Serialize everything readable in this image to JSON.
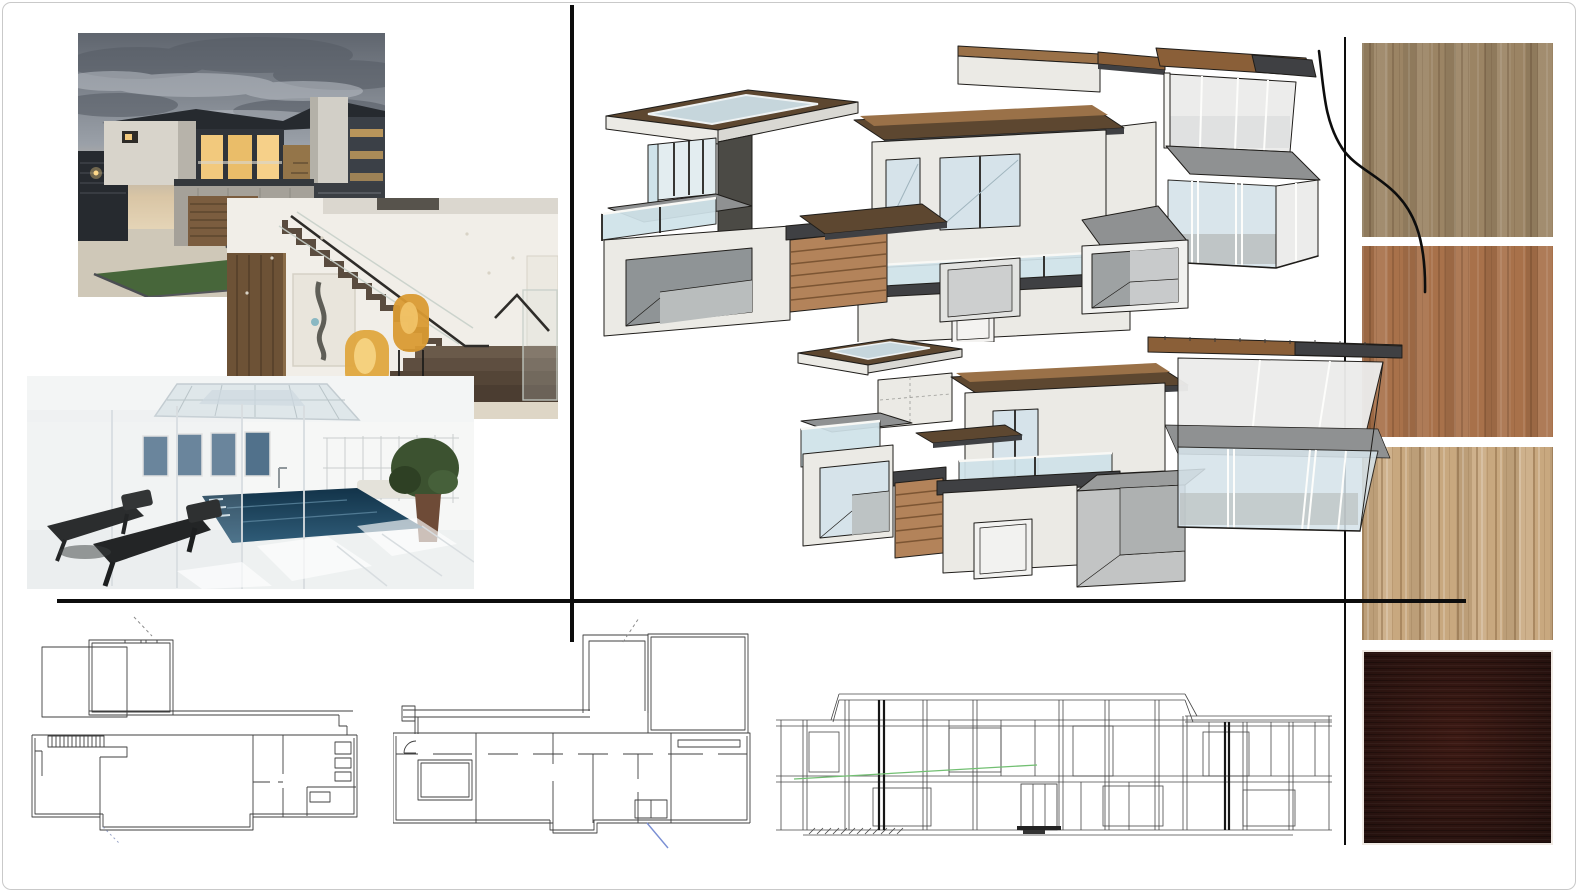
{
  "board": {
    "type": "architecture-design-moodboard",
    "background": "#ffffff",
    "frame_color": "#c9c9c9"
  },
  "palette": {
    "page_bg": "#ffffff",
    "page_border": "#c9c9c9",
    "divider": "#0d0d0d",
    "ink": "#1f1d1a",
    "wall": "#ebeae5",
    "wall_shade": "#d9d8d3",
    "wall_dark": "#4b4a45",
    "roof_brown": "#8a5f38",
    "roof_dark": "#5d4730",
    "roof_cap": "#9a7148",
    "fascia_dark": "#3f4043",
    "slab_gray": "#8f9192",
    "glass_blue": "#cfe2e9",
    "glass_pale": "#ececeb",
    "glass_sky": "#d6e3ea",
    "slat_wood": "#b3835a",
    "slat_line": "#7c5533",
    "concrete": "#a5a199",
    "plan_line": "#3f3f3f",
    "plan_soft": "#8a8a8a",
    "plan_blue": "#7a8fd4",
    "plan_green": "#72bf72",
    "sky_top": "#5f656e",
    "sky_mid": "#9aa0a8",
    "sky_glow": "#d9c5a5",
    "cloud_dark": "#575d66",
    "cloud_light": "#b9bec5",
    "dusk_charcoal": "#262a2f",
    "warm_window": "#f2c97d",
    "lawn_green": "#4b6a36",
    "gravel": "#cfc8b8",
    "garage_wood": "#7b5d3f",
    "cream_wall": "#f1eee8",
    "wood_panel": "#6d5236",
    "step_brown": "#5a4c3f",
    "lamp_amber": "#d99a33",
    "lamp_glow": "#f2c469",
    "artwork_canvas": "#e9e5dc",
    "pool_deep": "#123349",
    "pool_mid": "#2f5c78",
    "skylight_blue": "#dfe7ea",
    "plant_green": "#3c5230",
    "pot_brown": "#6e4b37",
    "gym_dark": "#2a2c2e",
    "floor_beige": "#ded6c6",
    "rail_black": "#2e2c29"
  },
  "inspiration_photos": [
    {
      "name": "exterior-dusk-photo"
    },
    {
      "name": "staircase-photo"
    },
    {
      "name": "indoor-pool-photo"
    }
  ],
  "model_views": [
    {
      "name": "sketchup-model-view-upper"
    },
    {
      "name": "sketchup-model-view-lower"
    }
  ],
  "technical_drawings": [
    {
      "name": "floor-plan-left"
    },
    {
      "name": "floor-plan-center"
    },
    {
      "name": "wireframe-elevation"
    }
  ],
  "material_swatches": [
    {
      "name": "wood-veneer-oak",
      "color": "#9b8464"
    },
    {
      "name": "wood-veneer-cherry",
      "color": "#a8714a"
    },
    {
      "name": "wood-veneer-walnut-light",
      "color": "#c8a87f"
    },
    {
      "name": "wood-veneer-espresso",
      "color": "#301713"
    }
  ],
  "dividers": {
    "color": "#0d0d0d"
  }
}
